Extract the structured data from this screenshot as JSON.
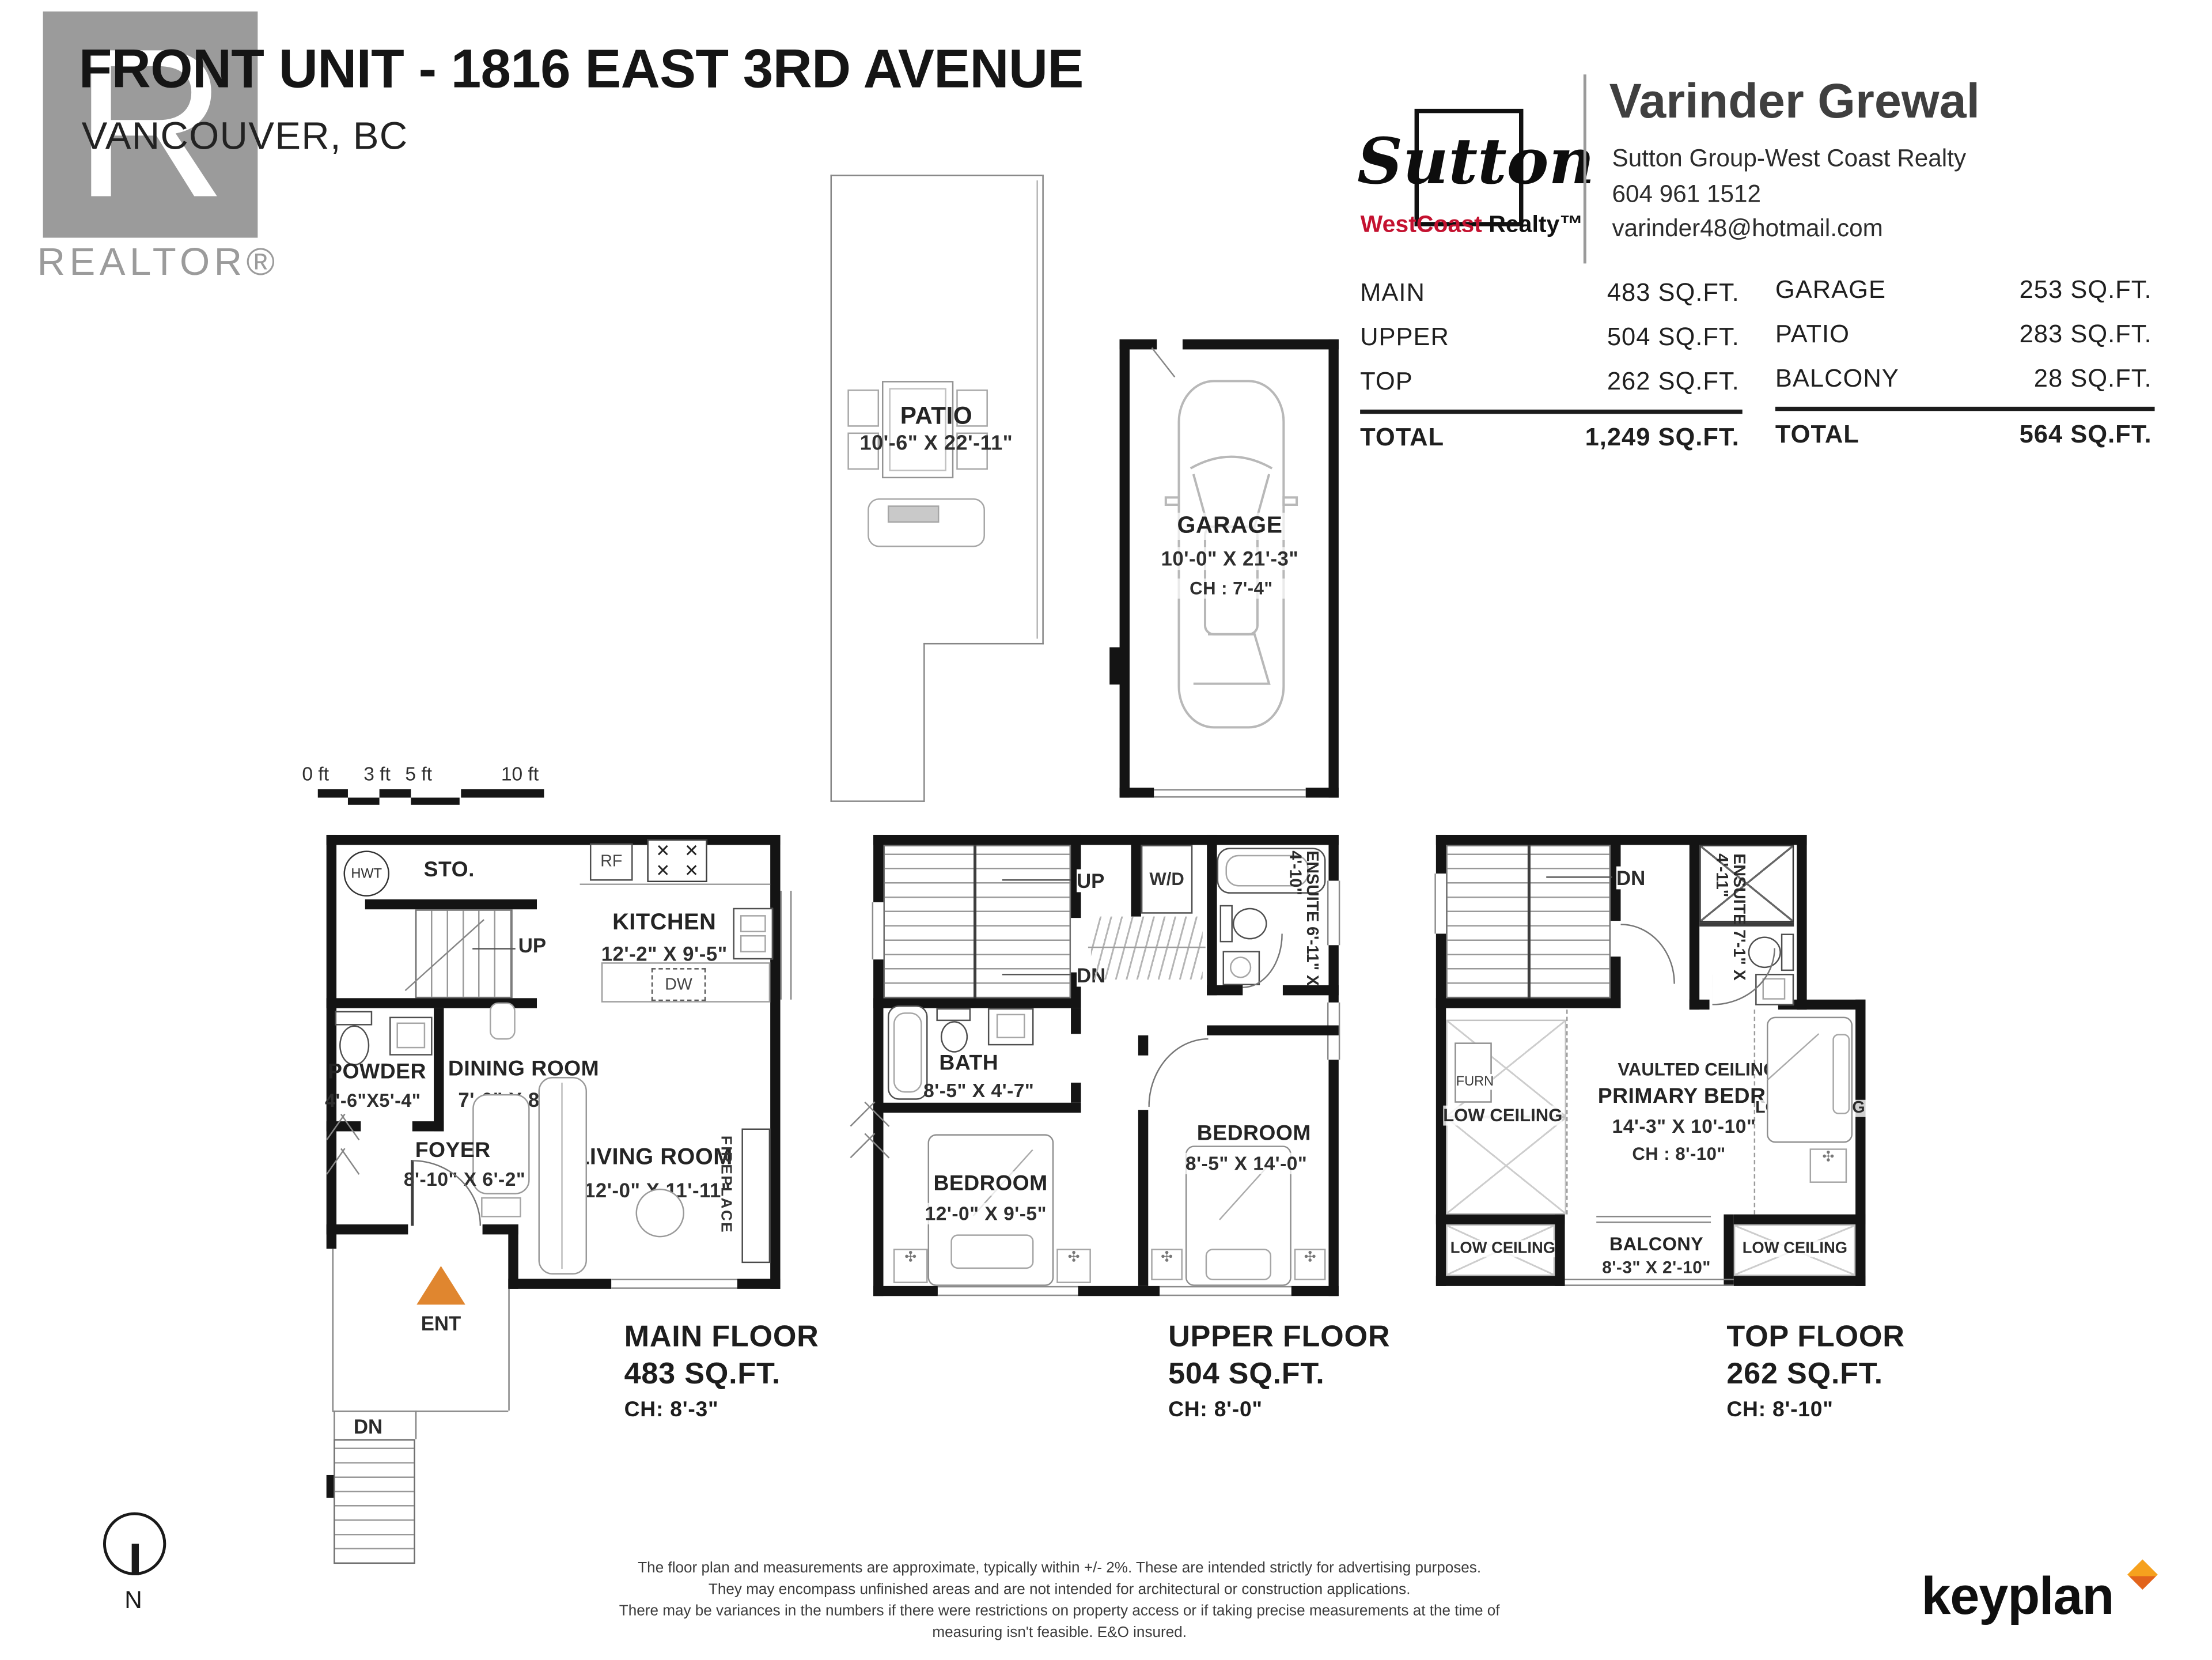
{
  "colors": {
    "accent_orange": "#e0862f",
    "brand_red": "#c41230",
    "logo_gray": "#9b9b9b",
    "keyplan_orange_top": "#f6a11e",
    "keyplan_orange_bottom": "#e2641c"
  },
  "icons": {
    "burner": "✕",
    "flower": "✣"
  },
  "header": {
    "title": "FRONT UNIT - 1816 EAST 3RD AVENUE",
    "subtitle": "VANCOUVER, BC",
    "realtor_logo_letter": "R",
    "realtor_label": "REALTOR®"
  },
  "brokerage": {
    "script": "Sutton",
    "westcoast": "WestCoast",
    "realty": "Realty™"
  },
  "agent": {
    "name": "Varinder Grewal",
    "company": "Sutton Group-West Coast Realty",
    "phone": "604 961 1512",
    "email": "varinder48@hotmail.com"
  },
  "areas": {
    "left": [
      {
        "label": "MAIN",
        "value": "483 SQ.FT."
      },
      {
        "label": "UPPER",
        "value": "504 SQ.FT."
      },
      {
        "label": "TOP",
        "value": "262 SQ.FT."
      }
    ],
    "left_total": {
      "label": "TOTAL",
      "value": "1,249 SQ.FT."
    },
    "right": [
      {
        "label": "GARAGE",
        "value": "253 SQ.FT."
      },
      {
        "label": "PATIO",
        "value": "283 SQ.FT."
      },
      {
        "label": "BALCONY",
        "value": "28 SQ.FT."
      }
    ],
    "right_total": {
      "label": "TOTAL",
      "value": "564 SQ.FT."
    }
  },
  "patio": {
    "name": "PATIO",
    "dims": "10'-6\" X 22'-11\""
  },
  "garage": {
    "name": "GARAGE",
    "dims": "10'-0\" X 21'-3\"",
    "ch": "CH : 7'-4\""
  },
  "scalebar": {
    "labels": [
      "0 ft",
      "3 ft",
      "5 ft",
      "10 ft"
    ]
  },
  "main_floor": {
    "hwt": "HWT",
    "sto": "STO.",
    "up": "UP",
    "rf": "RF",
    "dw": "DW",
    "kitchen": {
      "name": "KITCHEN",
      "dims": "12'-2\" X 9'-5\""
    },
    "powder": {
      "name": "POWDER",
      "dims": "4'-6\"X5'-4\""
    },
    "dining": {
      "name": "DINING ROOM",
      "dims": "7'-0\" X 8'-2\""
    },
    "foyer": {
      "name": "FOYER",
      "dims": "8'-10\" X 6'-2\""
    },
    "living": {
      "name": "LIVING ROOM",
      "dims": "12'-0\" X 11'-11\""
    },
    "fireplace": "FIREPLACE",
    "ent": "ENT",
    "dn": "DN",
    "caption": {
      "line1": "MAIN FLOOR",
      "line2": "483 SQ.FT.",
      "line3": "CH: 8'-3\""
    }
  },
  "upper_floor": {
    "up": "UP",
    "dn": "DN",
    "wd": "W/D",
    "ensuite": "ENSUITE 6'-11\" X 4'-10\"",
    "bath": {
      "name": "BATH",
      "dims": "8'-5\" X 4'-7\""
    },
    "bedroom1": {
      "name": "BEDROOM",
      "dims": "12'-0\" X 9'-5\""
    },
    "bedroom2": {
      "name": "BEDROOM",
      "dims": "8'-5\" X 14'-0\""
    },
    "caption": {
      "line1": "UPPER FLOOR",
      "line2": "504 SQ.FT.",
      "line3": "CH: 8'-0\""
    }
  },
  "top_floor": {
    "dn": "DN",
    "ensuite": "ENSUITE 7'-1\" X 4'-11\"",
    "furn": "FURN",
    "low_ceiling": "LOW CEILING",
    "vaulted": "VAULTED CEILING",
    "primary": {
      "name": "PRIMARY BEDROOM",
      "dims": "14'-3\" X 10'-10\"",
      "ch": "CH : 8'-10\""
    },
    "balcony": {
      "name": "BALCONY",
      "dims": "8'-3\" X 2'-10\""
    },
    "caption": {
      "line1": "TOP FLOOR",
      "line2": "262 SQ.FT.",
      "line3": "CH: 8'-10\""
    }
  },
  "footer": {
    "disclaimer": [
      "The floor plan and measurements are approximate, typically within +/- 2%. These are intended strictly for advertising purposes.",
      "They may encompass unfinished areas and are not intended for architectural or construction applications.",
      "There may be variances in the numbers if there were restrictions on property access or if taking precise measurements at the time of measuring isn't feasible. E&O insured."
    ],
    "brand": "keyplan"
  },
  "north": {
    "label": "N"
  }
}
